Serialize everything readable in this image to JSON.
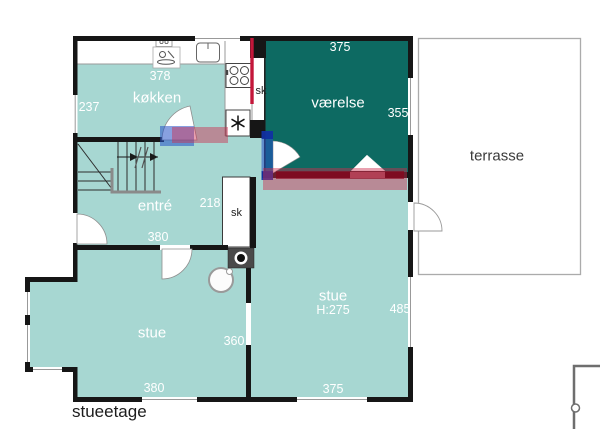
{
  "floor_label": "stueetage",
  "rooms": {
    "kokken": {
      "label": "køkken",
      "dim_top": "378",
      "dim_left": "237"
    },
    "vaerelse": {
      "label": "værelse",
      "dim_top": "375",
      "dim_right": "355"
    },
    "entre": {
      "label": "entré",
      "dim_corridor": "218",
      "dim_bottom": "380"
    },
    "stue_left": {
      "label": "stue",
      "dim_right": "360",
      "dim_bottom": "380"
    },
    "stue_right": {
      "label": "stue",
      "ceiling_height": "H:275",
      "dim_right": "485",
      "dim_bottom": "375"
    },
    "terrasse": {
      "label": "terrasse"
    }
  },
  "closets": {
    "kitchen_closet": {
      "label": "sk"
    },
    "hall_closet": {
      "label": "sk"
    }
  },
  "colors": {
    "room_fill": "#a7d7d2",
    "highlight_room_fill": "#0d6a62",
    "wall": "#161616",
    "radiator_red": "#c3173a",
    "overlay_red": "rgba(206,44,77,0.45)",
    "overlay_red_deep": "rgba(140,0,25,0.6)",
    "overlay_blue": "rgba(38,82,198,0.55)",
    "overlay_blue_deep": "rgba(15,45,160,0.85)",
    "terrace_border": "#ababab"
  }
}
